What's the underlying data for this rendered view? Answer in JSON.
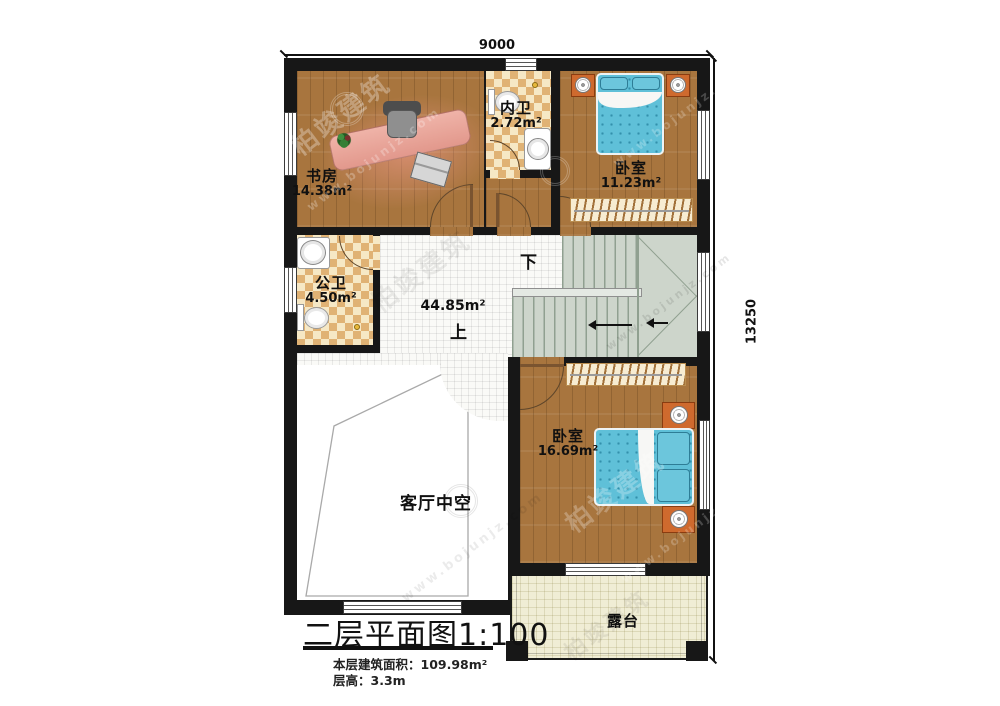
{
  "plan": {
    "title": "二层平面图1:100",
    "notes": {
      "area": "本层建筑面积：109.98m²",
      "height": "层高：3.3m"
    }
  },
  "dimensions": {
    "width": "9000",
    "height": "13250"
  },
  "rooms": {
    "study": {
      "name": "书房",
      "area": "14.38m²"
    },
    "inner_bath": {
      "name": "内卫",
      "area": "2.72m²"
    },
    "bedroom1": {
      "name": "卧室",
      "area": "11.23m²"
    },
    "public_bath": {
      "name": "公卫",
      "area": "4.50m²"
    },
    "hall": {
      "area": "44.85m²"
    },
    "bedroom2": {
      "name": "卧室",
      "area": "16.69m²"
    },
    "living_void": {
      "name": "客厅中空"
    },
    "terrace": {
      "name": "露台"
    }
  },
  "stairs": {
    "down_label": "下",
    "up_label": "上"
  },
  "watermark": {
    "text": "柏竣建筑",
    "url": "www.bojunjz.com"
  },
  "colors": {
    "wall": "#171717",
    "wood": "#a8753e",
    "tile_light": "#f6e8c5",
    "tile_dark": "#e0b274",
    "hall_tile": "#fafaf7",
    "stair": "#cdd5cb",
    "terrace": "#f0edd5",
    "bed": "#5fc0d8",
    "desk": "#e8a89d",
    "nightstand": "#cf6a2e"
  }
}
